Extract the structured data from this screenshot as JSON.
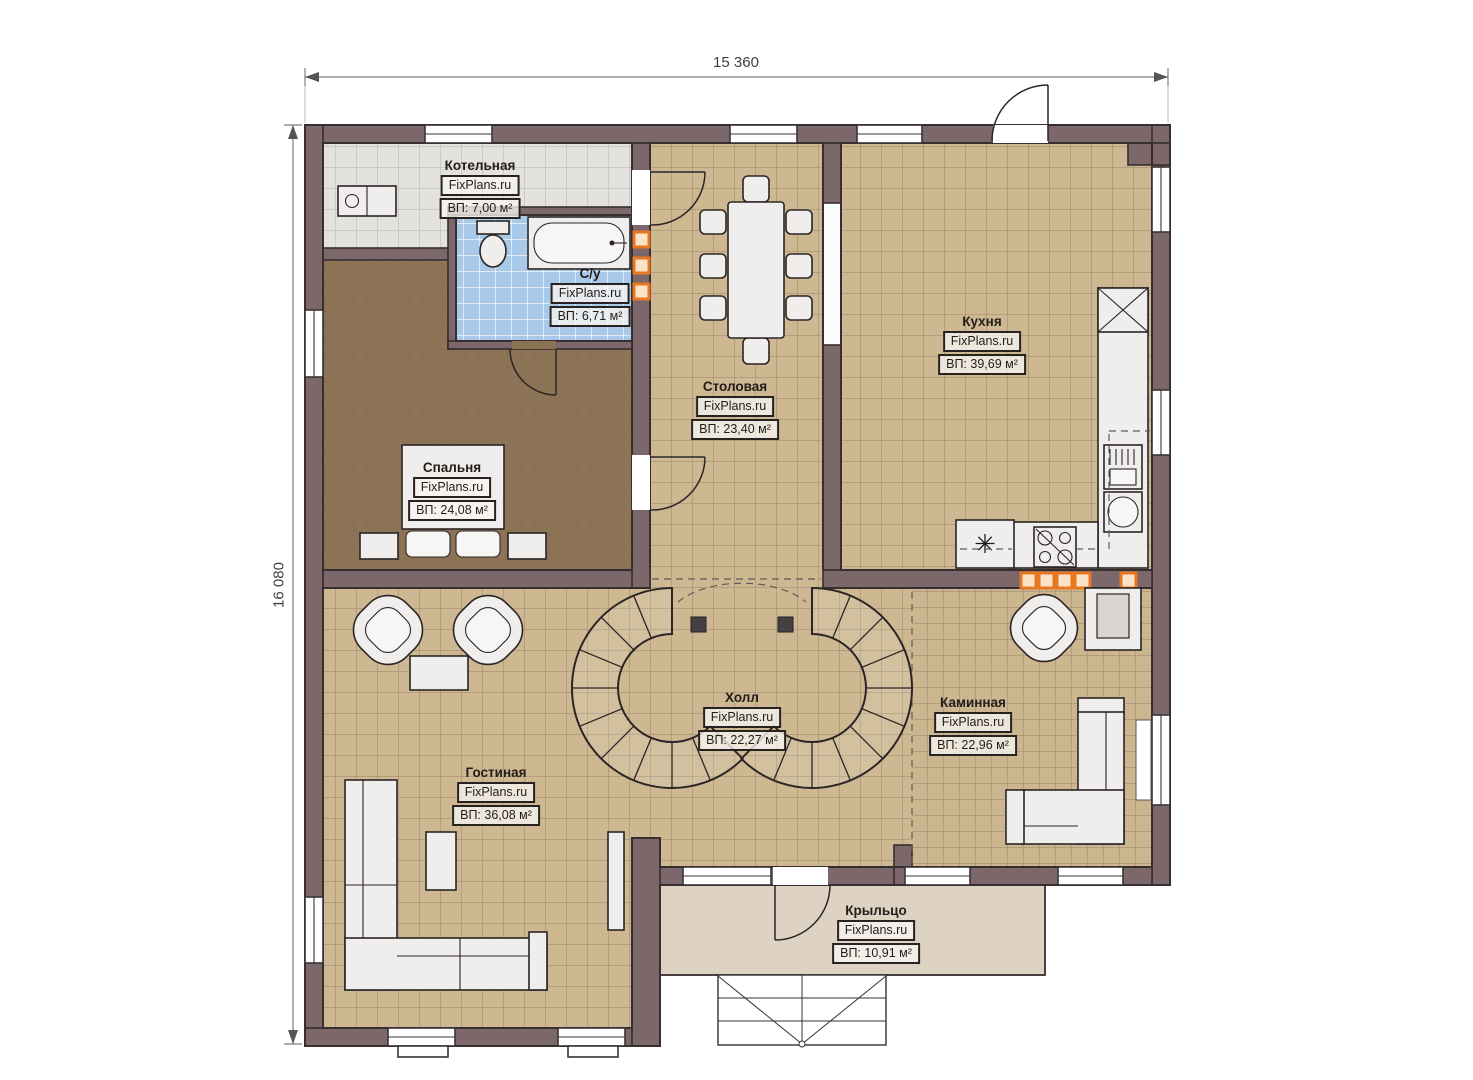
{
  "dimensions": {
    "width": "15 360",
    "height": "16 080"
  },
  "icons": {
    "freezer": "✳"
  },
  "colors": {
    "wall": "#7c686a",
    "tan_floor": "#cdb892",
    "gray_tile": "#e4e2df",
    "blue_tile": "#a9c9e9",
    "bedroom_floor": "#8c7355",
    "porch": "#ded3c2",
    "accent_orange": "#e87722"
  },
  "rooms": [
    {
      "key": "boiler",
      "name": "Котельная",
      "brand": "FixPlans.ru",
      "area": "ВП: 7,00 м²"
    },
    {
      "key": "bathroom",
      "name": "С/у",
      "brand": "FixPlans.ru",
      "area": "ВП: 6,71 м²"
    },
    {
      "key": "bedroom",
      "name": "Спальня",
      "brand": "FixPlans.ru",
      "area": "ВП: 24,08 м²"
    },
    {
      "key": "dining",
      "name": "Столовая",
      "brand": "FixPlans.ru",
      "area": "ВП: 23,40 м²"
    },
    {
      "key": "kitchen",
      "name": "Кухня",
      "brand": "FixPlans.ru",
      "area": "ВП: 39,69 м²"
    },
    {
      "key": "hall",
      "name": "Холл",
      "brand": "FixPlans.ru",
      "area": "ВП: 22,27 м²"
    },
    {
      "key": "fireplace",
      "name": "Каминная",
      "brand": "FixPlans.ru",
      "area": "ВП: 22,96 м²"
    },
    {
      "key": "living",
      "name": "Гостиная",
      "brand": "FixPlans.ru",
      "area": "ВП: 36,08 м²"
    },
    {
      "key": "porch",
      "name": "Крыльцо",
      "brand": "FixPlans.ru",
      "area": "ВП: 10,91 м²"
    }
  ]
}
